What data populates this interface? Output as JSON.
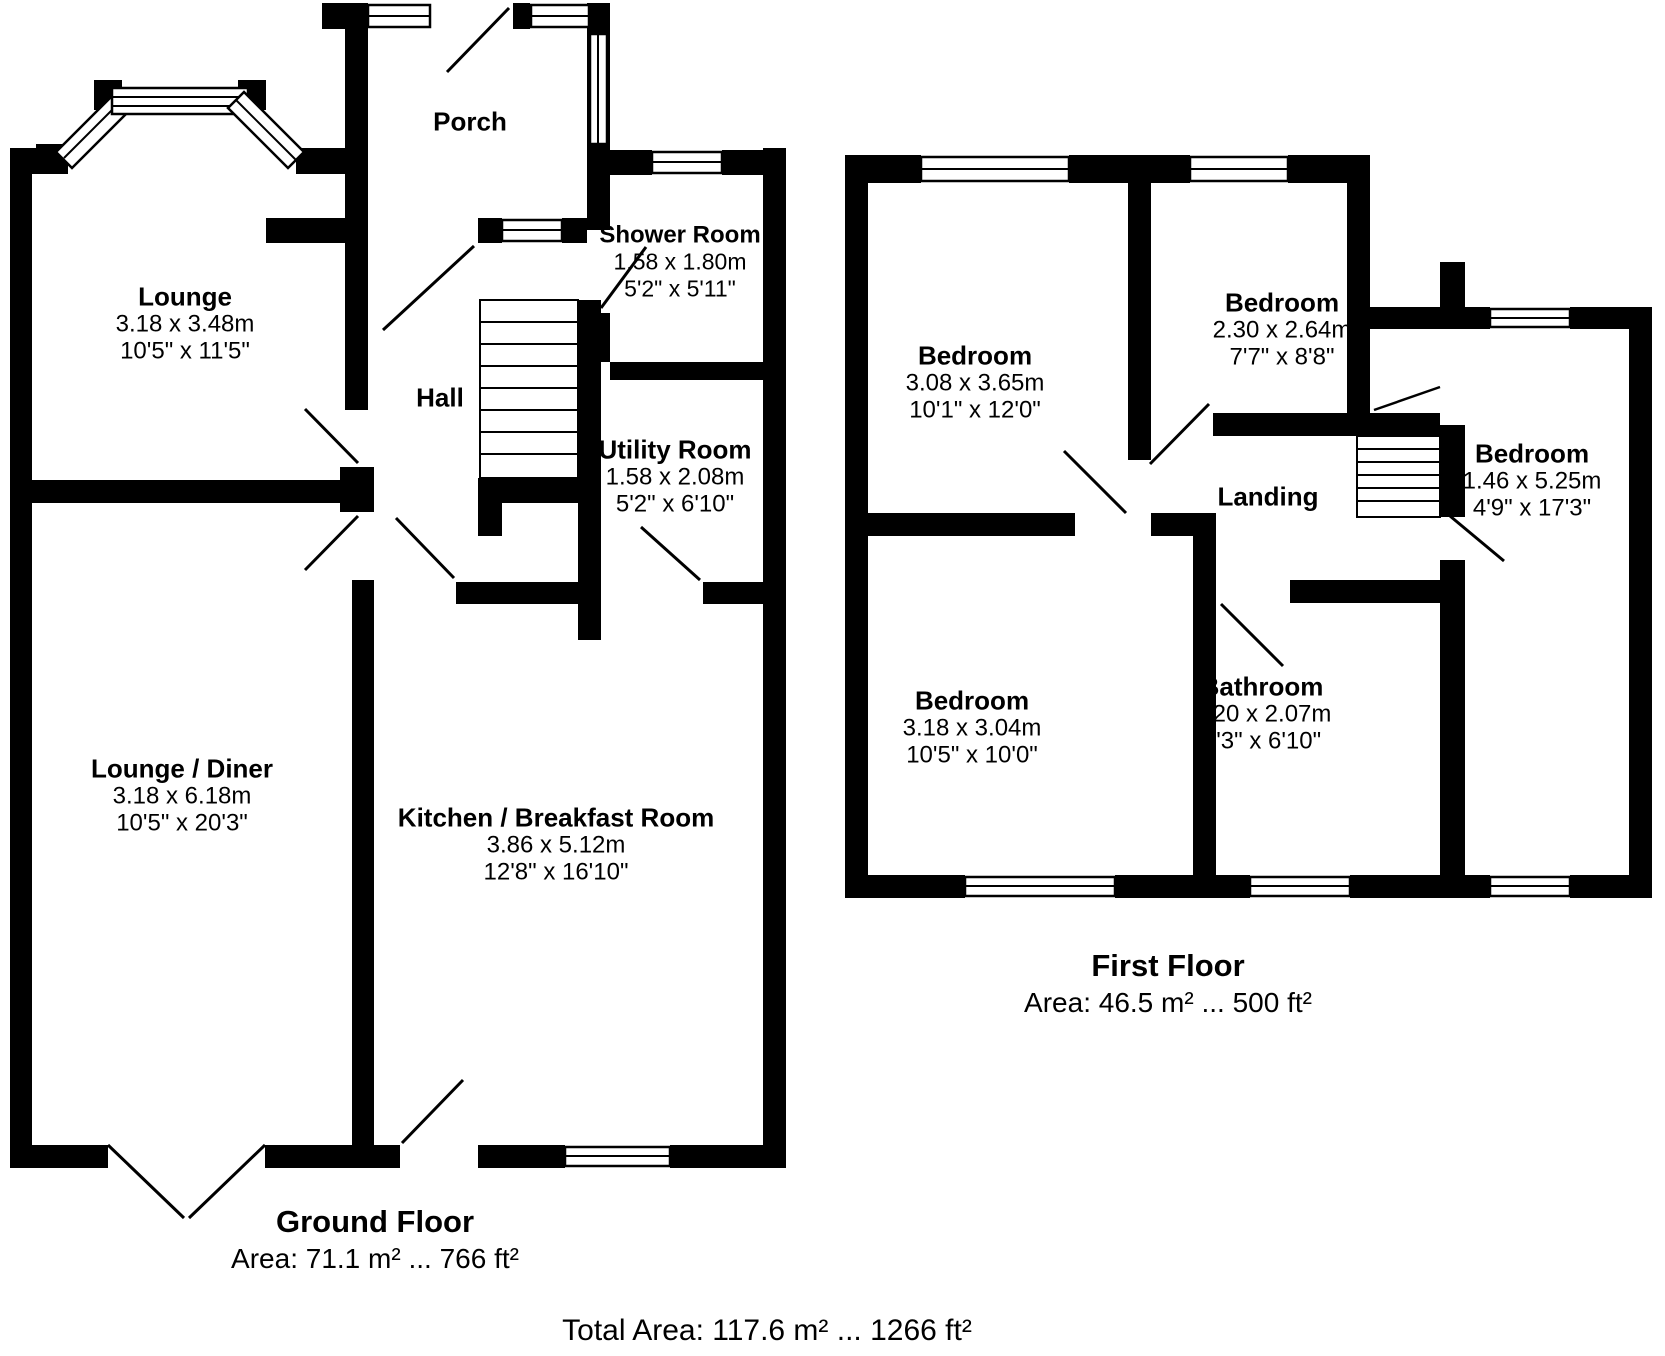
{
  "floorplan": {
    "colors": {
      "wall": "#000000",
      "background": "#ffffff",
      "text": "#000000"
    },
    "ground_floor": {
      "title": "Ground Floor",
      "area_label": "Area: 71.1 m² ... 766 ft²",
      "rooms": {
        "lounge": {
          "name": "Lounge",
          "metric": "3.18 x 3.48m",
          "imperial": "10'5\" x 11'5\""
        },
        "porch": {
          "name": "Porch"
        },
        "shower_room": {
          "name": "Shower Room",
          "metric": "1.58 x 1.80m",
          "imperial": "5'2\" x 5'11\""
        },
        "hall": {
          "name": "Hall"
        },
        "utility_room": {
          "name": "Utility Room",
          "metric": "1.58 x 2.08m",
          "imperial": "5'2\" x 6'10\""
        },
        "lounge_diner": {
          "name": "Lounge / Diner",
          "metric": "3.18 x 6.18m",
          "imperial": "10'5\" x 20'3\""
        },
        "kitchen": {
          "name": "Kitchen / Breakfast Room",
          "metric": "3.86 x 5.12m",
          "imperial": "12'8\" x 16'10\""
        }
      }
    },
    "first_floor": {
      "title": "First Floor",
      "area_label": "Area: 46.5 m² ... 500 ft²",
      "rooms": {
        "bedroom_1": {
          "name": "Bedroom",
          "metric": "3.08 x 3.65m",
          "imperial": "10'1\" x 12'0\""
        },
        "bedroom_2": {
          "name": "Bedroom",
          "metric": "2.30 x 2.64m",
          "imperial": "7'7\" x 8'8\""
        },
        "bedroom_right": {
          "name": "Bedroom",
          "metric": "1.46 x 5.25m",
          "imperial": "4'9\" x 17'3\""
        },
        "bedroom_3": {
          "name": "Bedroom",
          "metric": "3.18 x 3.04m",
          "imperial": "10'5\" x 10'0\""
        },
        "bathroom": {
          "name": "Bathroom",
          "metric": "2.20 x 2.07m",
          "imperial": "7'3\" x 6'10\""
        },
        "landing": {
          "name": "Landing"
        }
      }
    },
    "total_area_label": "Total Area: 117.6 m² ... 1266 ft²"
  }
}
